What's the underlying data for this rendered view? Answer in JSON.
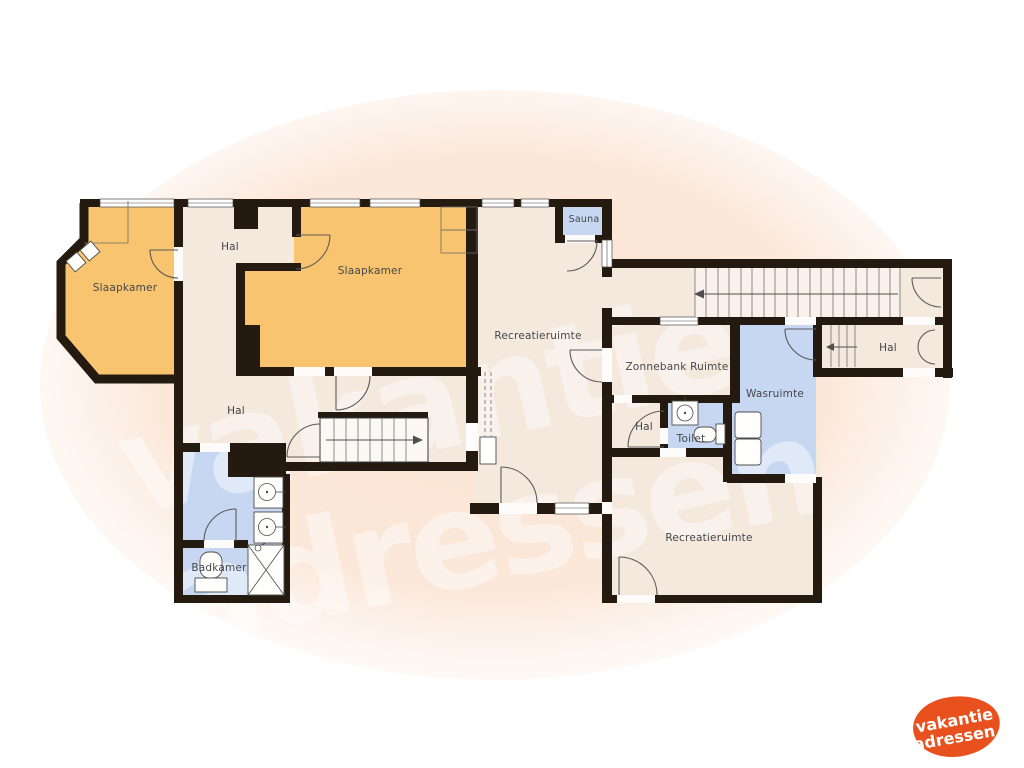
{
  "watermark": {
    "line1": "vakantie",
    "line2": "adressen"
  },
  "logo": {
    "line1": "vakantie",
    "line2": "adressen"
  },
  "rooms": {
    "slaapkamer_left": {
      "label": "Slaapkamer"
    },
    "hal_top": {
      "label": "Hal"
    },
    "slaapkamer_main": {
      "label": "Slaapkamer"
    },
    "sauna": {
      "label": "Sauna"
    },
    "recreatieruimte_main": {
      "label": "Recreatieruimte"
    },
    "zonnebank": {
      "label": "Zonnebank Ruimte"
    },
    "hal_right": {
      "label": "Hal"
    },
    "wasruimte": {
      "label": "Wasruimte"
    },
    "hal_small": {
      "label": "Hal"
    },
    "toilet": {
      "label": "Toilet"
    },
    "recreatieruimte_bottom": {
      "label": "Recreatieruimte"
    },
    "badkamer": {
      "label": "Badkamer"
    },
    "hal_left": {
      "label": "Hal"
    }
  },
  "colors": {
    "walls": "#241a10",
    "floor_light": "#f5e9de",
    "floor_orange": "#f8c46f",
    "floor_blue": "#c7d7f1",
    "background_blob": "#fae3d2",
    "logo_orange": "#e8501d",
    "label_text": "#43474d",
    "watermark": "#ffffff"
  }
}
